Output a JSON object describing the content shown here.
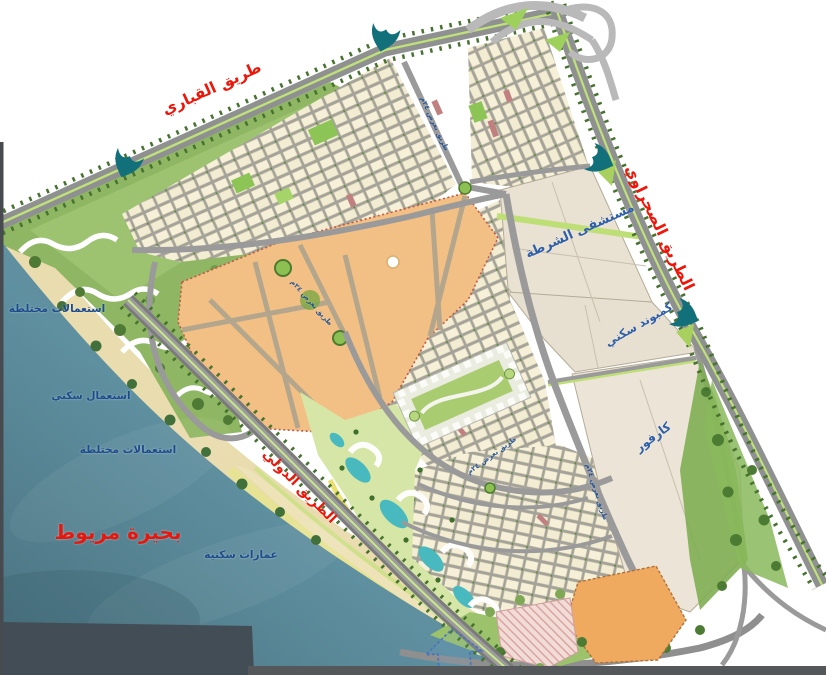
{
  "map": {
    "roads": {
      "qabbari": {
        "label": "طريق القباري"
      },
      "desert": {
        "label": "الطريق الصحراوي"
      },
      "international": {
        "label": "الطريق الدولي"
      }
    },
    "lake": {
      "label": "بحيرة مريوط"
    },
    "shore_zones": [
      {
        "label": "استعمالات مختلطة"
      },
      {
        "label": "استعمال سكني"
      },
      {
        "label": "استعمالات مختلطة"
      },
      {
        "label": "عمارات سكنية"
      }
    ],
    "parcels": {
      "police_hospital": {
        "label": "مستشفى الشرطة"
      },
      "residential_compound": {
        "label": "كمبوند سكني"
      },
      "carrefour": {
        "label": "كارفور"
      }
    },
    "street_labels": [
      {
        "label": "طريق بعرض ٢٤م"
      },
      {
        "label": "طريق بعرض ٢٤م"
      },
      {
        "label": "طريق بعرض ٢٤م"
      },
      {
        "label": "طريق بعرض ٢٤م"
      }
    ],
    "icons": {
      "entrance_marker": "entrance-arrow-icon",
      "north_arrow": "north-arrow-icon"
    }
  },
  "colors": {
    "road_label": "#ee1509",
    "lake_label": "#e8170e",
    "parcel_label": "#2e5fa9",
    "zone_label": "#1d4c8e",
    "water": "#5f90a0",
    "sand": "#e9dcae",
    "downtown_orange": "#f2bf84",
    "parcel_beige": "#e9e1d2",
    "block_cream": "#f6f0d8",
    "greenery": "#7fae53",
    "lagoon": "#49b9c0",
    "entrance_marker": "#11707a"
  }
}
